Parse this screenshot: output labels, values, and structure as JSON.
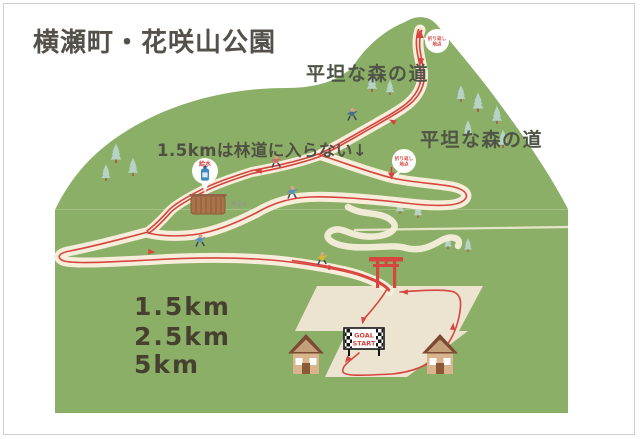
{
  "title": "横瀬町・花咲山公園",
  "distances": {
    "d1": "1.5km",
    "d2": "2.5km",
    "d3": "5km"
  },
  "annotations": {
    "flat_forest_top": "平坦な森の道",
    "flat_forest_right": "平坦な森の道",
    "course_note": "1.5kmは林道に入らない↓",
    "observatory": "展望台",
    "water_station": "給水",
    "turnaround_top": {
      "line1": "折り返し",
      "line2": "地点"
    },
    "turnaround_mid": {
      "line1": "折り返し",
      "line2": "地点"
    }
  },
  "banner": {
    "goal": "GOAL",
    "start": "START"
  },
  "colors": {
    "hill_green": "#8caf67",
    "trail_cream": "#f6eedb",
    "field_cream": "#ece3d0",
    "route_red": "#d6453e",
    "title_text": "#55504a"
  }
}
